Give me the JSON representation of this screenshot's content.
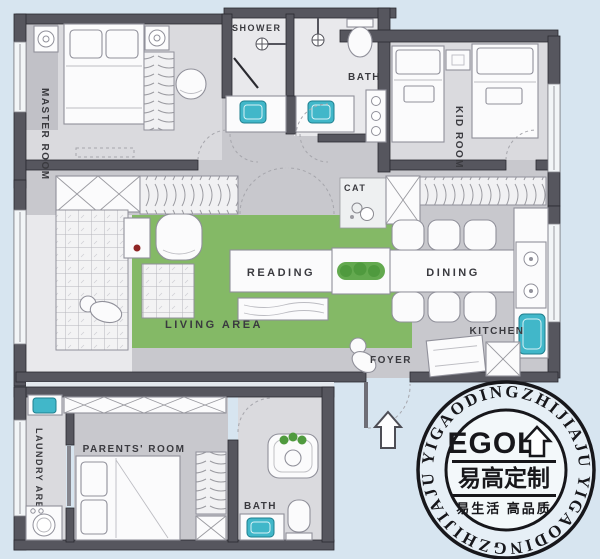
{
  "title": "apartment floor plan",
  "colors": {
    "background": "#d7e5f0",
    "wall": "#56565e",
    "wall_outline": "#2a2a30",
    "corridor": "#c8c8cd",
    "floor_light": "#e9e9ec",
    "floor_mid": "#dadade",
    "floor_dark": "#c1c1c7",
    "living_green": "#84b966",
    "plant_green": "#4f9a3e",
    "sink_teal": "#41b7c9",
    "furniture_white": "#fbfbfc",
    "furniture_stroke": "#90909a",
    "stamp_ink": "#17171b",
    "accent_red": "#8e2424"
  },
  "rooms": {
    "master": "MASTER ROOM",
    "shower": "SHOWER",
    "bath_top": "BATH",
    "kid": "KID ROOM",
    "cat": "CAT",
    "reading": "READING",
    "dining": "DINING",
    "living": "LIVING AREA",
    "kitchen": "KITCHEN",
    "foyer": "FOYER",
    "laundry": "LAUNDRY AREA",
    "parents": "PARENTS' ROOM",
    "bath_bottom": "BATH"
  },
  "watermark": {
    "ring_text": "YIGAODINGZHIJIAJU",
    "logo": "EGOL",
    "brand_cn": "易高定制",
    "slogan_cn": "易生活 高品质"
  },
  "icons": {
    "entrance_arrow": "up-arrow",
    "logo_arrow": "up-arrow",
    "shower_head": "circle-with-cross",
    "sink": "teal-basin",
    "stove": "two-burner-circles",
    "washer": "front-load-drum",
    "lamp": "concentric-circles"
  }
}
